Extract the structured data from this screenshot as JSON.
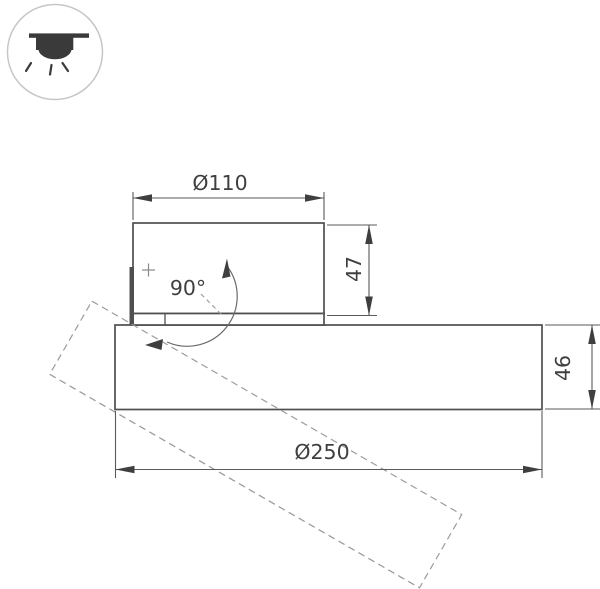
{
  "pictogram": {
    "name": "surface-mounted-downlight-icon",
    "ring_color": "#c6c6c6",
    "glyph_color": "#3a3a3a"
  },
  "drawing": {
    "dimensions": {
      "head_diameter": "Ø110",
      "head_height": "47",
      "base_diameter": "Ø250",
      "base_height": "46",
      "tilt_angle": "90°"
    },
    "colors": {
      "outline": "#4f4f4f",
      "dimension_lines": "#5a5a5a",
      "dashed_projection": "#9b9b9b",
      "labels": "#3f3f3f",
      "background": "#ffffff"
    }
  }
}
